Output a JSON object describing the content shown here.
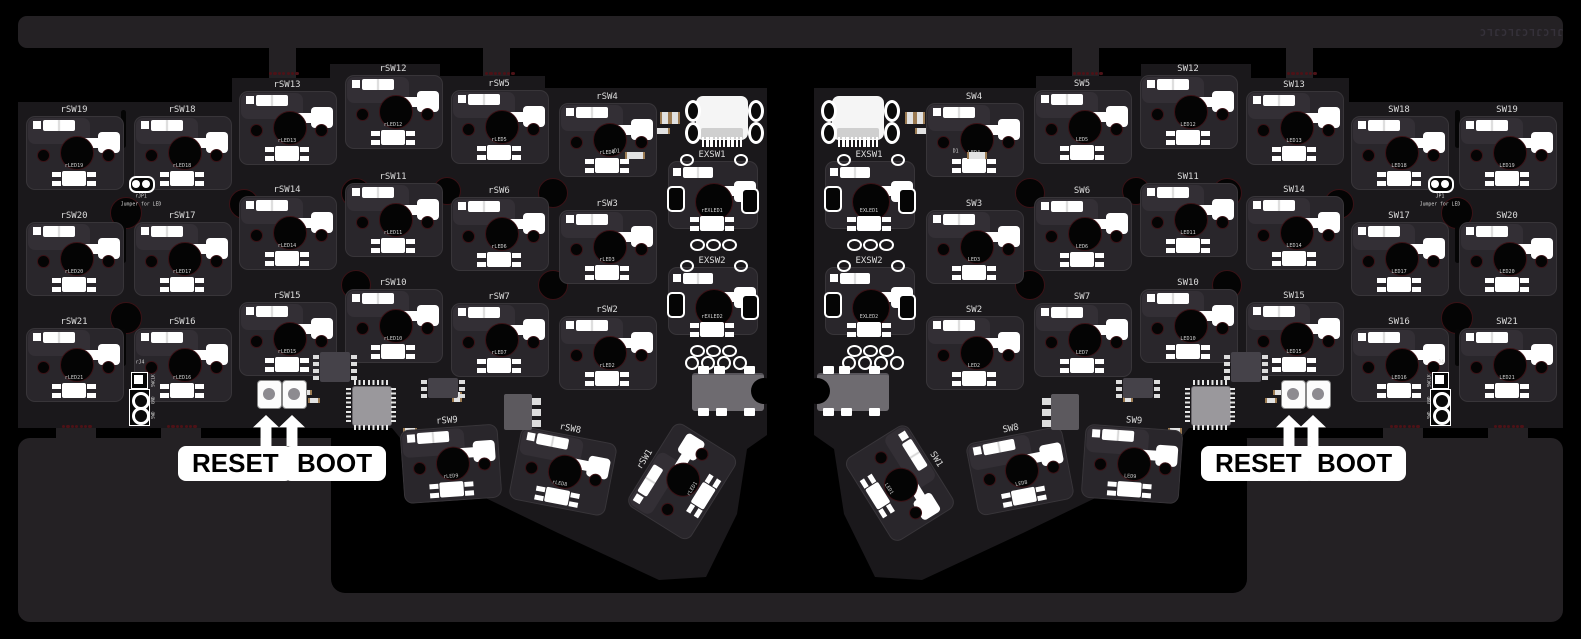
{
  "panel": {
    "brand_text": "JLCJLCJLCJLC"
  },
  "annotations": {
    "reset_label": "RESET",
    "boot_label": "BOOT"
  },
  "colors": {
    "board": "#1a181b",
    "frame": "#242124",
    "silkscreen": "#f2f2f2",
    "mouse_bite": "#4d1217",
    "hole_ring": "#3a1216",
    "mcu": "#9a989c"
  },
  "left_half": {
    "keys": [
      {
        "id": "rSW19",
        "led": "rLED19",
        "x": 74,
        "y": 111,
        "rot": 0
      },
      {
        "id": "rSW18",
        "led": "rLED18",
        "x": 182,
        "y": 111,
        "rot": 0
      },
      {
        "id": "rSW13",
        "led": "rLED13",
        "x": 287,
        "y": 86,
        "rot": 0
      },
      {
        "id": "rSW12",
        "led": "rLED12",
        "x": 393,
        "y": 70,
        "rot": 0
      },
      {
        "id": "rSW5",
        "led": "rLED5",
        "x": 499,
        "y": 85,
        "rot": 0
      },
      {
        "id": "rSW4",
        "led": "rLED4",
        "x": 607,
        "y": 98,
        "rot": 0
      },
      {
        "id": "rSW20",
        "led": "rLED20",
        "x": 74,
        "y": 217,
        "rot": 0
      },
      {
        "id": "rSW17",
        "led": "rLED17",
        "x": 182,
        "y": 217,
        "rot": 0
      },
      {
        "id": "rSW14",
        "led": "rLED14",
        "x": 287,
        "y": 191,
        "rot": 0
      },
      {
        "id": "rSW11",
        "led": "rLED11",
        "x": 393,
        "y": 178,
        "rot": 0
      },
      {
        "id": "rSW6",
        "led": "rLED6",
        "x": 499,
        "y": 192,
        "rot": 0
      },
      {
        "id": "rSW3",
        "led": "rLED3",
        "x": 607,
        "y": 205,
        "rot": 0
      },
      {
        "id": "rSW21",
        "led": "rLED21",
        "x": 74,
        "y": 323,
        "rot": 0
      },
      {
        "id": "rSW16",
        "led": "rLED16",
        "x": 182,
        "y": 323,
        "rot": 0
      },
      {
        "id": "rSW15",
        "led": "rLED15",
        "x": 287,
        "y": 297,
        "rot": 0
      },
      {
        "id": "rSW10",
        "led": "rLED10",
        "x": 393,
        "y": 284,
        "rot": 0
      },
      {
        "id": "rSW7",
        "led": "rLED7",
        "x": 499,
        "y": 298,
        "rot": 0
      },
      {
        "id": "rSW2",
        "led": "rLED2",
        "x": 607,
        "y": 311,
        "rot": 0
      },
      {
        "id": "rSW9",
        "led": "rLED9",
        "x": 447,
        "y": 422,
        "rot": -4
      },
      {
        "id": "rSW8",
        "led": "rLED8",
        "x": 570,
        "y": 430,
        "rot": 11
      },
      {
        "id": "rSW1",
        "led": "rLED1",
        "x": 646,
        "y": 460,
        "rot": -58
      }
    ],
    "extra_keys": [
      {
        "id": "EXSW1",
        "led": "rEXLED1",
        "x": 712,
        "y": 156,
        "pads4": false
      },
      {
        "id": "EXSW2",
        "led": "rEXLED2",
        "x": 712,
        "y": 262,
        "pads4": true
      }
    ],
    "jumper": {
      "ref": "rJP1",
      "label": "Jumper for LED"
    },
    "debug": {
      "ref": "rJ4",
      "pins": [
        "SWCLK",
        "GND",
        "SWD"
      ]
    },
    "diode_ref": "rD1"
  },
  "right_half": {
    "keys": [
      {
        "id": "SW19",
        "led": "LED19",
        "x": 1507,
        "y": 111,
        "rot": 0
      },
      {
        "id": "SW18",
        "led": "LED18",
        "x": 1399,
        "y": 111,
        "rot": 0
      },
      {
        "id": "SW13",
        "led": "LED13",
        "x": 1294,
        "y": 86,
        "rot": 0
      },
      {
        "id": "SW12",
        "led": "LED12",
        "x": 1188,
        "y": 70,
        "rot": 0
      },
      {
        "id": "SW5",
        "led": "LED5",
        "x": 1082,
        "y": 85,
        "rot": 0
      },
      {
        "id": "SW4",
        "led": "LED4",
        "x": 974,
        "y": 98,
        "rot": 0
      },
      {
        "id": "SW20",
        "led": "LED20",
        "x": 1507,
        "y": 217,
        "rot": 0
      },
      {
        "id": "SW17",
        "led": "LED17",
        "x": 1399,
        "y": 217,
        "rot": 0
      },
      {
        "id": "SW14",
        "led": "LED14",
        "x": 1294,
        "y": 191,
        "rot": 0
      },
      {
        "id": "SW11",
        "led": "LED11",
        "x": 1188,
        "y": 178,
        "rot": 0
      },
      {
        "id": "SW6",
        "led": "LED6",
        "x": 1082,
        "y": 192,
        "rot": 0
      },
      {
        "id": "SW3",
        "led": "LED3",
        "x": 974,
        "y": 205,
        "rot": 0
      },
      {
        "id": "SW21",
        "led": "LED21",
        "x": 1507,
        "y": 323,
        "rot": 0
      },
      {
        "id": "SW16",
        "led": "LED16",
        "x": 1399,
        "y": 323,
        "rot": 0
      },
      {
        "id": "SW15",
        "led": "LED15",
        "x": 1294,
        "y": 297,
        "rot": 0
      },
      {
        "id": "SW10",
        "led": "LED10",
        "x": 1188,
        "y": 284,
        "rot": 0
      },
      {
        "id": "SW7",
        "led": "LED7",
        "x": 1082,
        "y": 298,
        "rot": 0
      },
      {
        "id": "SW2",
        "led": "LED2",
        "x": 974,
        "y": 311,
        "rot": 0
      },
      {
        "id": "SW9",
        "led": "LED9",
        "x": 1134,
        "y": 422,
        "rot": 4
      },
      {
        "id": "SW8",
        "led": "LED8",
        "x": 1011,
        "y": 430,
        "rot": -11
      },
      {
        "id": "SW1",
        "led": "LED1",
        "x": 935,
        "y": 460,
        "rot": 58
      }
    ],
    "extra_keys": [
      {
        "id": "EXSW1",
        "led": "EXLED1",
        "x": 869,
        "y": 156,
        "pads4": false
      },
      {
        "id": "EXSW2",
        "led": "EXLED2",
        "x": 869,
        "y": 262,
        "pads4": true
      }
    ],
    "jumper": {
      "ref": "JP1",
      "label": "Jumper for LED"
    },
    "debug": {
      "ref": "J4",
      "pins": [
        "SWCLK",
        "GND",
        "SWD"
      ]
    },
    "diode_ref": "D1"
  }
}
